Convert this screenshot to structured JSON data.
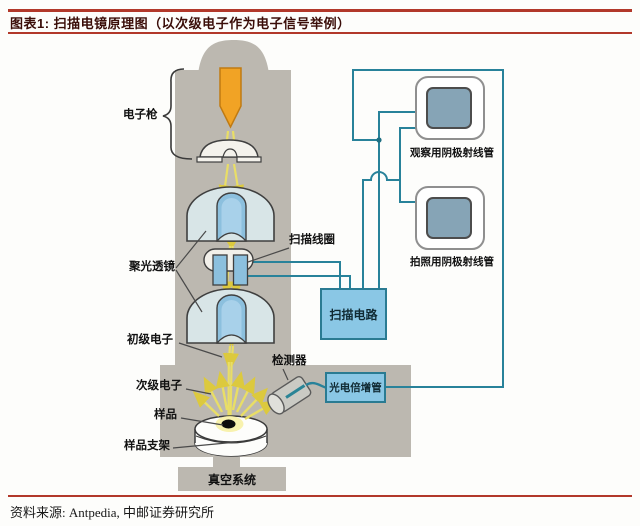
{
  "header": {
    "title": "图表1: 扫描电镜原理图（以次级电子作为电子信号举例）",
    "accent_color": "#b2382a",
    "title_color": "#3a0d08"
  },
  "footer": {
    "source": "资料来源: Antpedia, 中邮证券研究所"
  },
  "diagram": {
    "labels": {
      "electron_gun": "电子枪",
      "condenser_lens": "聚光透镜",
      "scan_coil": "扫描线圈",
      "primary_electrons": "初级电子",
      "secondary_electrons": "次级电子",
      "sample": "样品",
      "sample_holder": "样品支架",
      "detector": "检测器",
      "vacuum_system": "真空系统"
    },
    "boxes": {
      "scan_circuit": "扫描电路",
      "photomultiplier": "光电倍增管",
      "crt_observe": "观察用阴极射线管",
      "crt_photo": "拍照用阴极射线管"
    },
    "colors": {
      "column_gray": "#bcb8b0",
      "lens_body": "#d8e5e7",
      "lens_bore": "#8cc0de",
      "beam_yellow": "#e9de66",
      "filament_orange": "#f1a325",
      "wire_teal": "#28829a",
      "box_blue": "#8ac7e5",
      "box_border": "#2a7b92",
      "crt_screen": "#86a4b6"
    }
  }
}
